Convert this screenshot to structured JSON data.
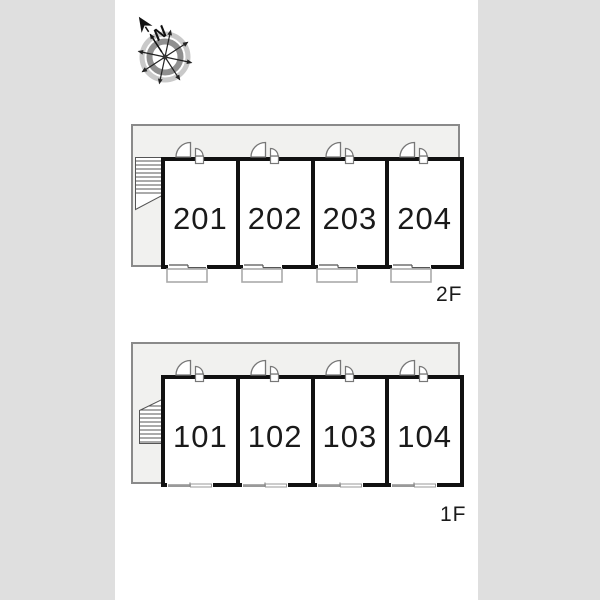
{
  "page": {
    "background_color": "#dfdfdf",
    "panel_color": "#ffffff"
  },
  "colors": {
    "wall": "#111111",
    "plan_area_fill": "#f1f1ef",
    "plan_area_border": "#8a8a8a",
    "door_stroke": "#777777",
    "stair_stroke": "#555555",
    "balcony_stroke": "#aaaaaa",
    "window_gray": "#999999",
    "text": "#1a1a1a"
  },
  "compass": {
    "north_label": "N"
  },
  "floors": [
    {
      "id": "2F",
      "label": "2F",
      "rooms": [
        {
          "number": "201"
        },
        {
          "number": "202"
        },
        {
          "number": "203"
        },
        {
          "number": "204"
        }
      ],
      "features": {
        "stairs": "left",
        "balconies": true
      }
    },
    {
      "id": "1F",
      "label": "1F",
      "rooms": [
        {
          "number": "101"
        },
        {
          "number": "102"
        },
        {
          "number": "103"
        },
        {
          "number": "104"
        }
      ],
      "features": {
        "stairs": "left",
        "balconies": false
      }
    }
  ]
}
